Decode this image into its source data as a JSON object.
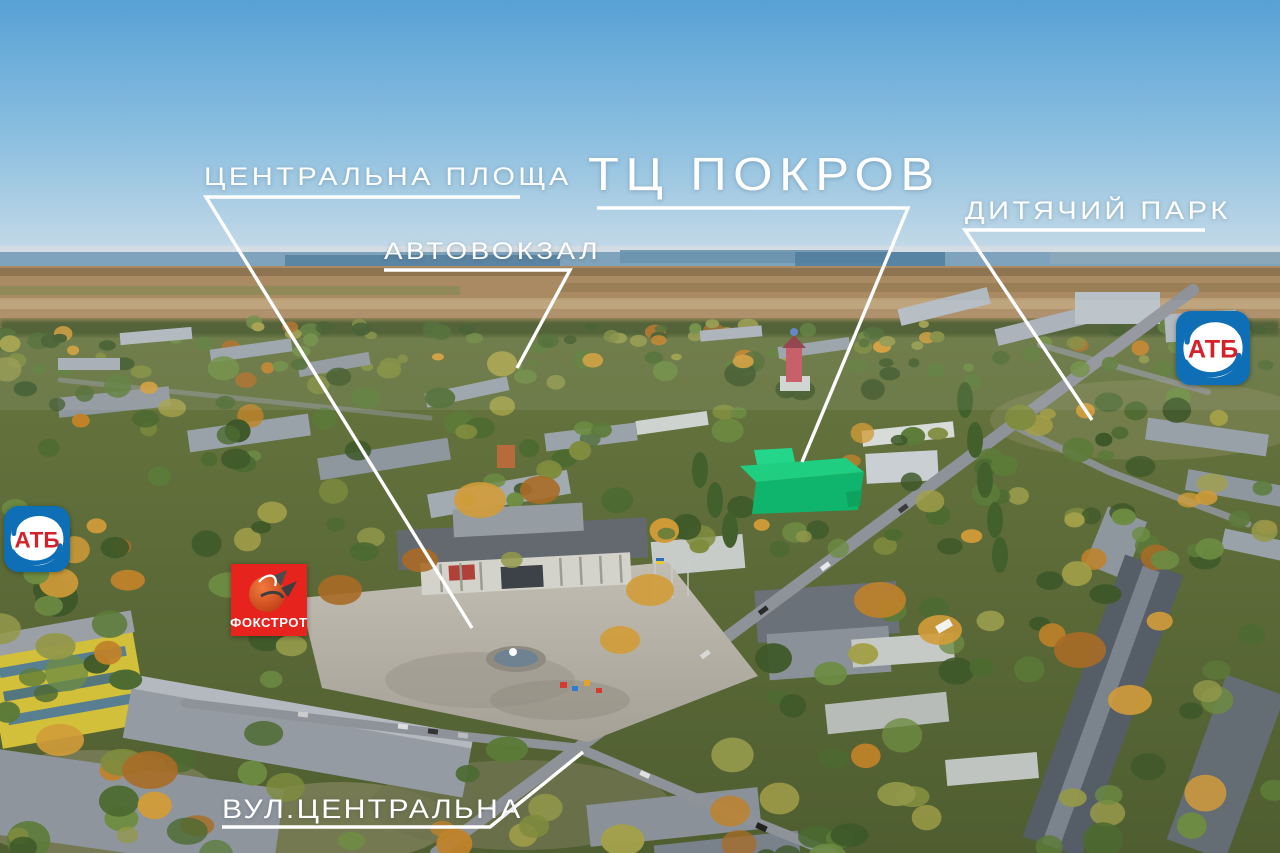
{
  "scene": {
    "title": "ТЦ ПОКРОВ",
    "labels": {
      "central_square": "ЦЕНТРАЛЬНА ПЛОЩА",
      "bus_station": "АВТОВОКЗАЛ",
      "children_park": "ДИТЯЧИЙ ПАРК",
      "street": "ВУЛ.ЦЕНТРАЛЬНА"
    },
    "logos": {
      "atb": "АТБ",
      "foxtrot": "ФОКСТРОТ"
    },
    "colors": {
      "annotation": "#ffffff",
      "highlight_building": "#17ca7d",
      "atb_blue": "#0e6fb6",
      "atb_red": "#d6202a",
      "foxtrot_red": "#e7231d"
    }
  }
}
